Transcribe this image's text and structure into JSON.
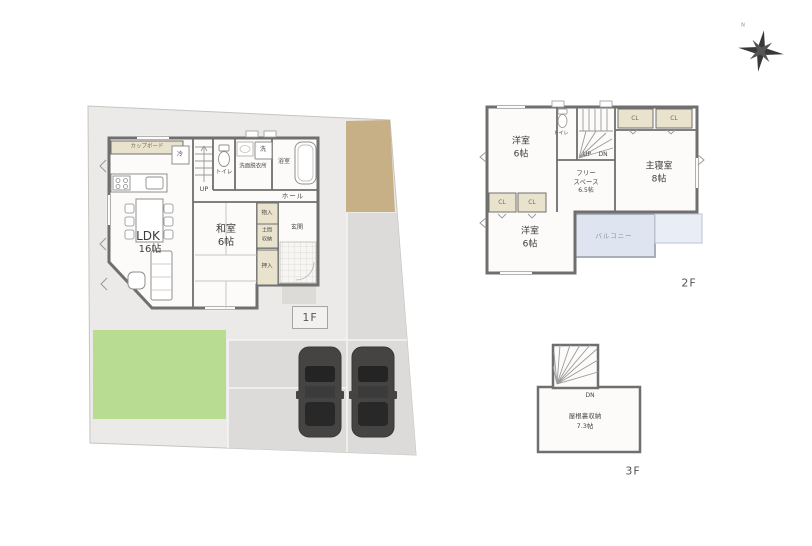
{
  "compass": {
    "north": "N"
  },
  "floor1": {
    "floor_label": "1F",
    "ldk_name": "LDK",
    "ldk_size": "16帖",
    "washitsu_name": "和室",
    "washitsu_size": "6帖",
    "cupboard": "カップボード",
    "fridge": "冷",
    "toilet": "トイレ",
    "washroom": "洗面脱衣所",
    "washer": "洗",
    "bath": "浴室",
    "stairs_up": "UP",
    "hall": "ホール",
    "storage": "物入",
    "doma_line1": "土間",
    "doma_line2": "収納",
    "entrance": "玄関",
    "oshiire": "押入"
  },
  "floor2": {
    "floor_label": "2F",
    "bedroom1_name": "洋室",
    "bedroom1_size": "6帖",
    "toilet": "トイレ",
    "stairs_up": "UP",
    "stairs_down": "DN",
    "closet": "CL",
    "master_name": "主寝室",
    "master_size": "8帖",
    "free_line1": "フリー",
    "free_line2": "スペース",
    "free_line3": "6.5帖",
    "bedroom2_name": "洋室",
    "bedroom2_size": "6帖",
    "balcony": "バルコニー"
  },
  "floor3": {
    "floor_label": "3F",
    "stairs_down": "DN",
    "attic_name": "屋根裏収納",
    "attic_size": "7.3帖"
  },
  "colors": {
    "site": "#ebeae8",
    "parking": "#dcdbd9",
    "lawn": "#b9dc93",
    "approach_tan": "#c7b085",
    "wall": "#6f6f6f",
    "closet_tan": "#e9e3cd",
    "balcony_blue": "#dee4f0",
    "car_body": "#454443"
  }
}
